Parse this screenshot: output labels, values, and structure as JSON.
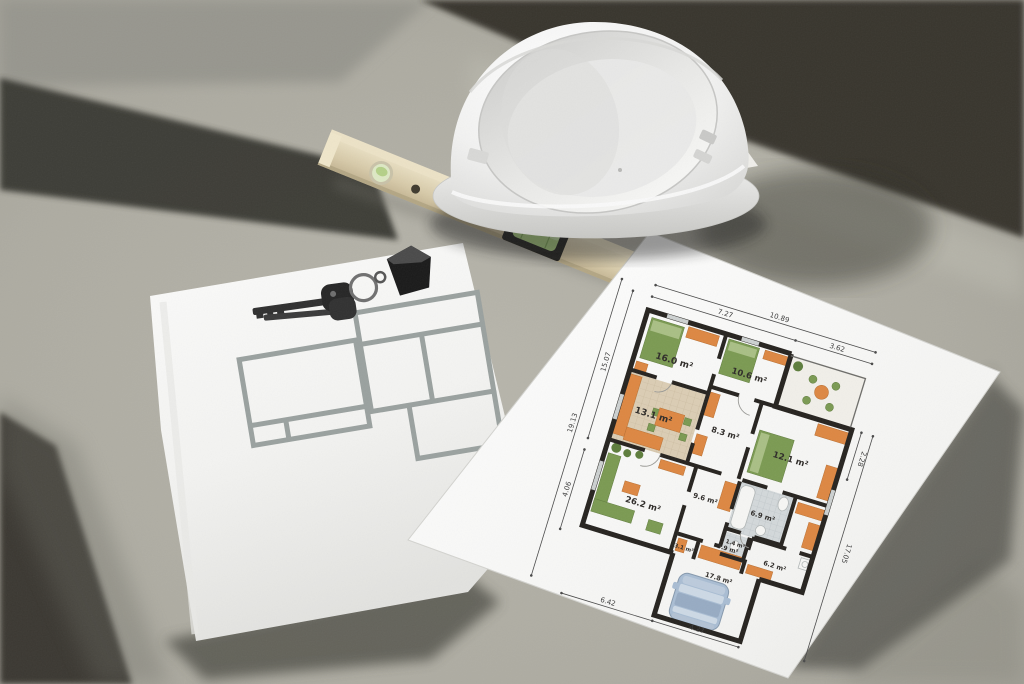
{
  "scene_title": "Construction flat-lay: hard hat, spirit level, keys and floor plans on concrete",
  "plan": {
    "rooms": [
      {
        "id": "bedroom-1",
        "area": "16.0 m²"
      },
      {
        "id": "bedroom-2",
        "area": "10.6 m²"
      },
      {
        "id": "kitchen",
        "area": "13.1 m²"
      },
      {
        "id": "hall",
        "area": "8.3 m²"
      },
      {
        "id": "bedroom-3",
        "area": "12.1 m²"
      },
      {
        "id": "living-room",
        "area": "26.2 m²"
      },
      {
        "id": "corridor",
        "area": "9.6 m²"
      },
      {
        "id": "bathroom",
        "area": "6.9 m²"
      },
      {
        "id": "wc",
        "area": "1.4 m²"
      },
      {
        "id": "storage",
        "area": "6.2 m²"
      },
      {
        "id": "closet-1",
        "area": "3.1 m²"
      },
      {
        "id": "closet-2",
        "area": "3.9 m²"
      },
      {
        "id": "garage",
        "area": "17.8 m²"
      }
    ],
    "dimensions": [
      {
        "id": "top-outer",
        "value": "10.89"
      },
      {
        "id": "top-inner",
        "value": "7.27"
      },
      {
        "id": "terrace",
        "value": "3.62"
      },
      {
        "id": "left-outer",
        "value": "19.13"
      },
      {
        "id": "left-inner",
        "value": "15.07"
      },
      {
        "id": "left-lower",
        "value": "4.06"
      },
      {
        "id": "right-upper",
        "value": "2.28"
      },
      {
        "id": "right-side",
        "value": "17.05"
      },
      {
        "id": "bottom-left",
        "value": "6.42"
      },
      {
        "id": "bottom-garage",
        "value": "4.27"
      }
    ]
  },
  "colors": {
    "concrete": "#aba99f",
    "shadow": "#38372f",
    "paper": "#f7f7f5",
    "plan_wall": "#26231f",
    "furniture_orange": "#dd8742",
    "furniture_green": "#7b9a52",
    "kitchen_tile": "#dbcdb4",
    "bath_tile": "#d3d8da",
    "car_blue": "#a9bdd3",
    "level_wood": "#d6c9a8",
    "vial_green": "#a9cd80",
    "helmet_white": "#f2f2f1",
    "sketch_gray": "#9aa19f",
    "keys_metal": "#2f2f2f"
  }
}
